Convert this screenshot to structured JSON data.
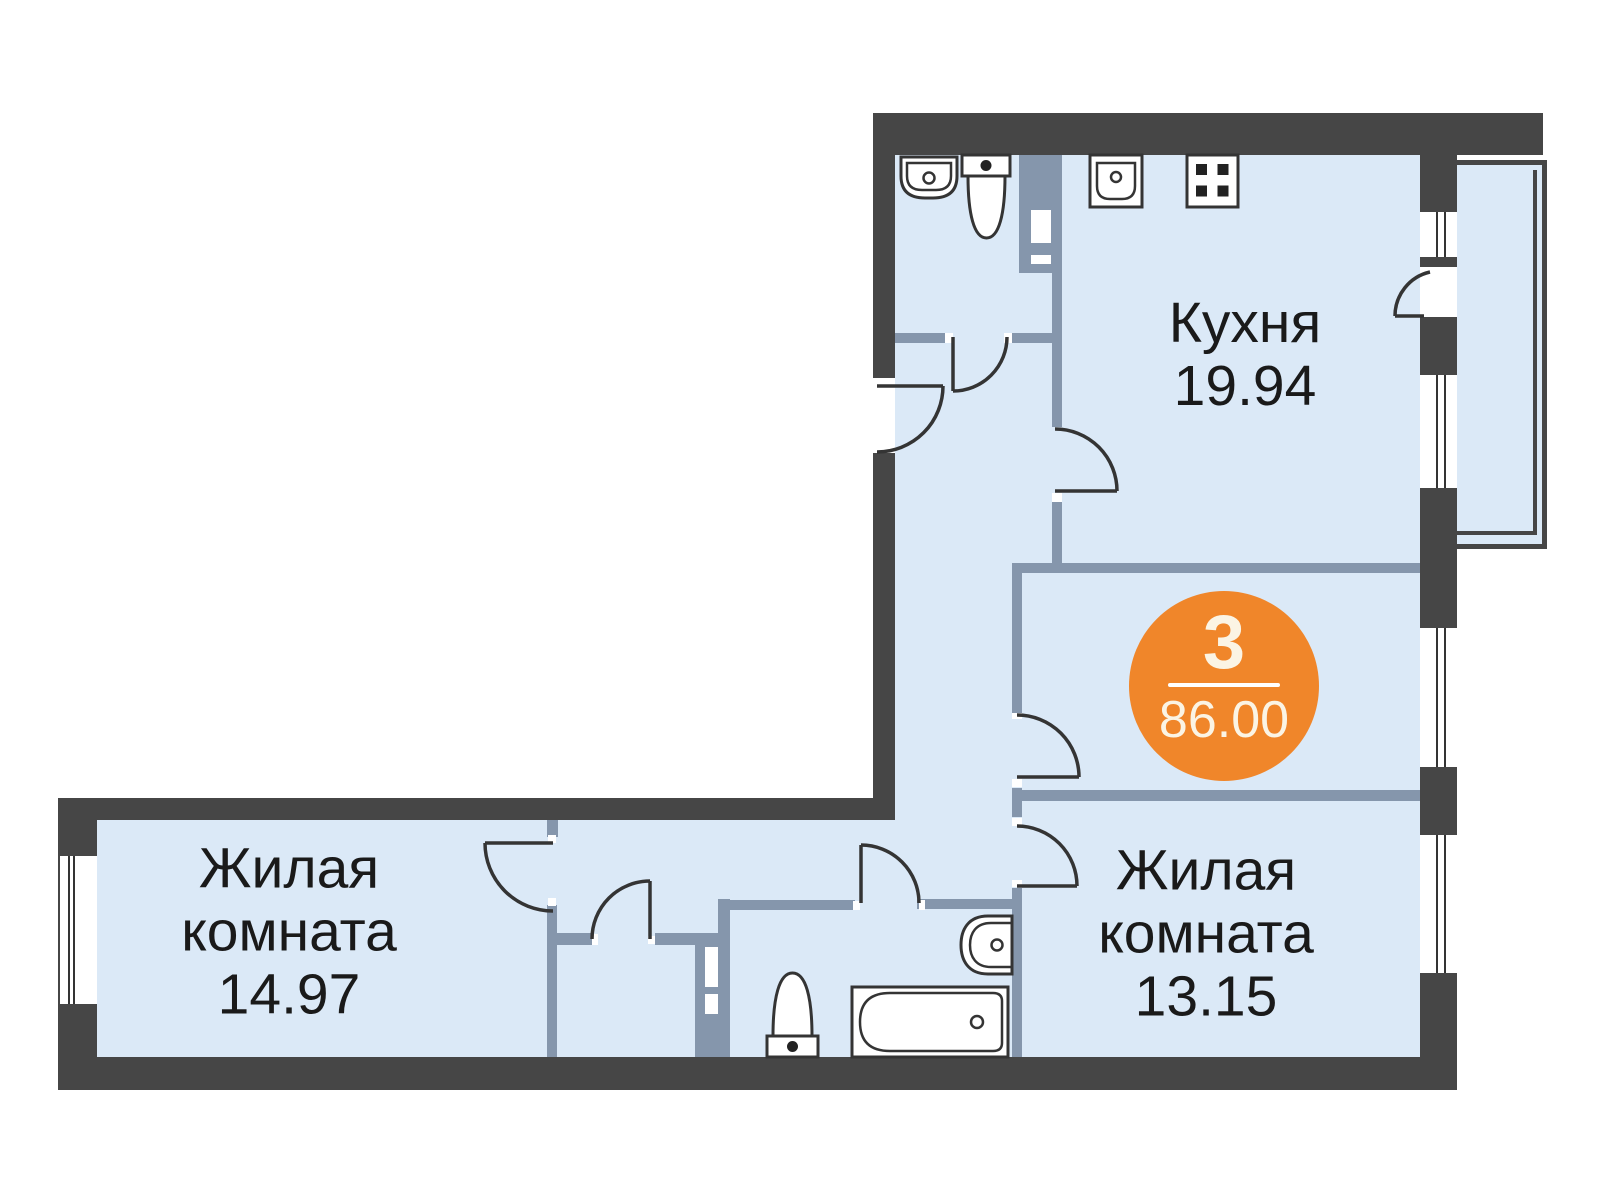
{
  "floor_plan": {
    "badge": {
      "rooms_count": "3",
      "total_area": "86.00"
    },
    "rooms": [
      {
        "id": "kitchen",
        "label": "Кухня",
        "area": "19.94"
      },
      {
        "id": "living-room-left",
        "label_line1": "Жилая",
        "label_line2": "комната",
        "area": "14.97"
      },
      {
        "id": "living-room-right",
        "label_line1": "Жилая",
        "label_line2": "комната",
        "area": "13.15"
      }
    ],
    "colors": {
      "accent_orange": "#F0862A",
      "exterior_wall": "#464646",
      "interior_wall": "#8596AC",
      "floor_fill": "#DBE9F7",
      "fixture_line": "#343434",
      "label_text": "#1A1A1A",
      "badge_text": "#FBF4E4"
    },
    "icons": [
      "washbasin-icon",
      "toilet-icon",
      "kitchen-sink-icon",
      "stove-icon",
      "bathtub-icon",
      "vent-shaft-icon",
      "window-icon",
      "door-arc-icon",
      "balcony-icon"
    ]
  }
}
